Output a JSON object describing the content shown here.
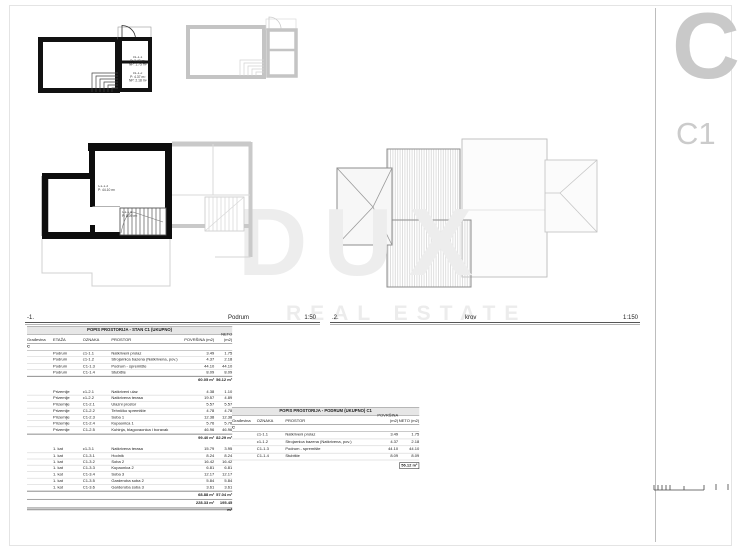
{
  "sheet": {
    "letter": "C",
    "code": "C1"
  },
  "titles": {
    "basement": {
      "index": "-1.",
      "label": "Podrum",
      "scale": "1:50"
    },
    "roof": {
      "index": ".2.",
      "label": "krov",
      "scale": "1:150"
    }
  },
  "watermark": {
    "word": "DUX",
    "subtitle": "REAL ESTATE"
  },
  "plan_labels": {
    "room_c1_1_1": {
      "code": "c1-1.1",
      "p": "P: 3.49 m²",
      "np": "NP: 1.75 m²"
    },
    "room_c1_1_2": {
      "code": "c1-1.2",
      "p": "P: 4.37 m²",
      "np": "NP: 2.18 m²"
    },
    "room_c1_1_3": {
      "code": "C1-1.3",
      "p": "P: 44.10 m²"
    },
    "room_c1_1_4": {
      "code": "C1-1.4",
      "p": "P: 8.09 m²"
    }
  },
  "table_main": {
    "title": "POPIS PROSTORIJA - STAN C1 (UKUPNO)",
    "columns": {
      "gradevina": "Građevina",
      "etaza": "ETAŽA",
      "oznaka": "OZNAKA",
      "prostor": "PROSTOR",
      "povrsina": "POVRŠINA (m2)",
      "neto": "NETO (m2)"
    },
    "group": "C",
    "sections": [
      {
        "rows": [
          {
            "etaza": "Podrum",
            "oznaka": "c1-1.1",
            "prostor": "Natkriveni prolaz",
            "povrsina": "3.49",
            "neto": "1.75"
          },
          {
            "etaza": "Podrum",
            "oznaka": "c1-1.2",
            "prostor": "Strojarnica bazena (Natkrivena, pov.)",
            "povrsina": "4.37",
            "neto": "2.18"
          },
          {
            "etaza": "Podrum",
            "oznaka": "C1-1.3",
            "prostor": "Podrum - spremište",
            "povrsina": "44.10",
            "neto": "44.10"
          },
          {
            "etaza": "Podrum",
            "oznaka": "C1-1.4",
            "prostor": "Stubište",
            "povrsina": "8.09",
            "neto": "8.09"
          }
        ],
        "total_povrsina": "60.05 m²",
        "total_neto": "56.12 m²"
      },
      {
        "rows": [
          {
            "etaza": "Prizemlje",
            "oznaka": "c1-2.1",
            "prostor": "Natkriveni ulaz",
            "povrsina": "4.38",
            "neto": "1.10"
          },
          {
            "etaza": "Prizemlje",
            "oznaka": "c1-2.2",
            "prostor": "Natkrivena terasa",
            "povrsina": "19.57",
            "neto": "4.89"
          },
          {
            "etaza": "Prizemlje",
            "oznaka": "C1-2.1",
            "prostor": "Ulazni prostor",
            "povrsina": "5.57",
            "neto": "5.57"
          },
          {
            "etaza": "Prizemlje",
            "oznaka": "C1-2.2",
            "prostor": "Tehničko spremište",
            "povrsina": "4.78",
            "neto": "4.78"
          },
          {
            "etaza": "Prizemlje",
            "oznaka": "C1-2.3",
            "prostor": "Soba 1",
            "povrsina": "12.38",
            "neto": "12.38"
          },
          {
            "etaza": "Prizemlje",
            "oznaka": "C1-2.4",
            "prostor": "Kupaonica 1",
            "povrsina": "5.76",
            "neto": "5.76"
          },
          {
            "etaza": "Prizemlje",
            "oznaka": "C1-2.5",
            "prostor": "Kuhinja, blagovaonica i boravak",
            "povrsina": "46.96",
            "neto": "46.96"
          }
        ],
        "total_povrsina": "99.40 m²",
        "total_neto": "82.29 m²"
      },
      {
        "rows": [
          {
            "etaza": "1. kat",
            "oznaka": "c1-3.1",
            "prostor": "Natkrivena terasa",
            "povrsina": "15.79",
            "neto": "3.95"
          },
          {
            "etaza": "1. kat",
            "oznaka": "C1-3.1",
            "prostor": "Hodnik",
            "povrsina": "8.24",
            "neto": "8.24"
          },
          {
            "etaza": "1. kat",
            "oznaka": "C1-3.2",
            "prostor": "Soba 2",
            "povrsina": "16.42",
            "neto": "16.42"
          },
          {
            "etaza": "1. kat",
            "oznaka": "C1-3.3",
            "prostor": "Kupaonica 2",
            "povrsina": "6.81",
            "neto": "6.81"
          },
          {
            "etaza": "1. kat",
            "oznaka": "C1-3.4",
            "prostor": "Soba 3",
            "povrsina": "12.17",
            "neto": "12.17"
          },
          {
            "etaza": "1. kat",
            "oznaka": "C1-3.5",
            "prostor": "Garderoba soba 2",
            "povrsina": "5.84",
            "neto": "5.84"
          },
          {
            "etaza": "1. kat",
            "oznaka": "C1-3.6",
            "prostor": "Garderoba soba 3",
            "povrsina": "3.61",
            "neto": "3.61"
          }
        ],
        "total_povrsina": "68.88 m²",
        "total_neto": "57.04 m²"
      }
    ],
    "grand_total_povrsina": "228.33 m²",
    "grand_total_neto": "195.45 m²"
  },
  "table_podrum": {
    "title": "POPIS PROSTORIJA - PODRUM (UKUPNO) C1",
    "columns": {
      "gradevina": "Građevina",
      "oznaka": "OZNAKA",
      "prostor": "PROSTOR",
      "povrsina": "POVRŠINA (m2)",
      "neto": "NETO (m2)"
    },
    "group": "C",
    "rows": [
      {
        "oznaka": "c1-1.1",
        "prostor": "Natkriveni prolaz",
        "povrsina": "3.49",
        "neto": "1.75"
      },
      {
        "oznaka": "c1-1.2",
        "prostor": "Strojarnica bazena (Natkrivena, pov.)",
        "povrsina": "4.37",
        "neto": "2.18"
      },
      {
        "oznaka": "C1-1.3",
        "prostor": "Podrum - spremište",
        "povrsina": "44.10",
        "neto": "44.10"
      },
      {
        "oznaka": "C1-1.4",
        "prostor": "Stubište",
        "povrsina": "8.09",
        "neto": "8.09"
      }
    ],
    "total": "56.12 m²"
  }
}
